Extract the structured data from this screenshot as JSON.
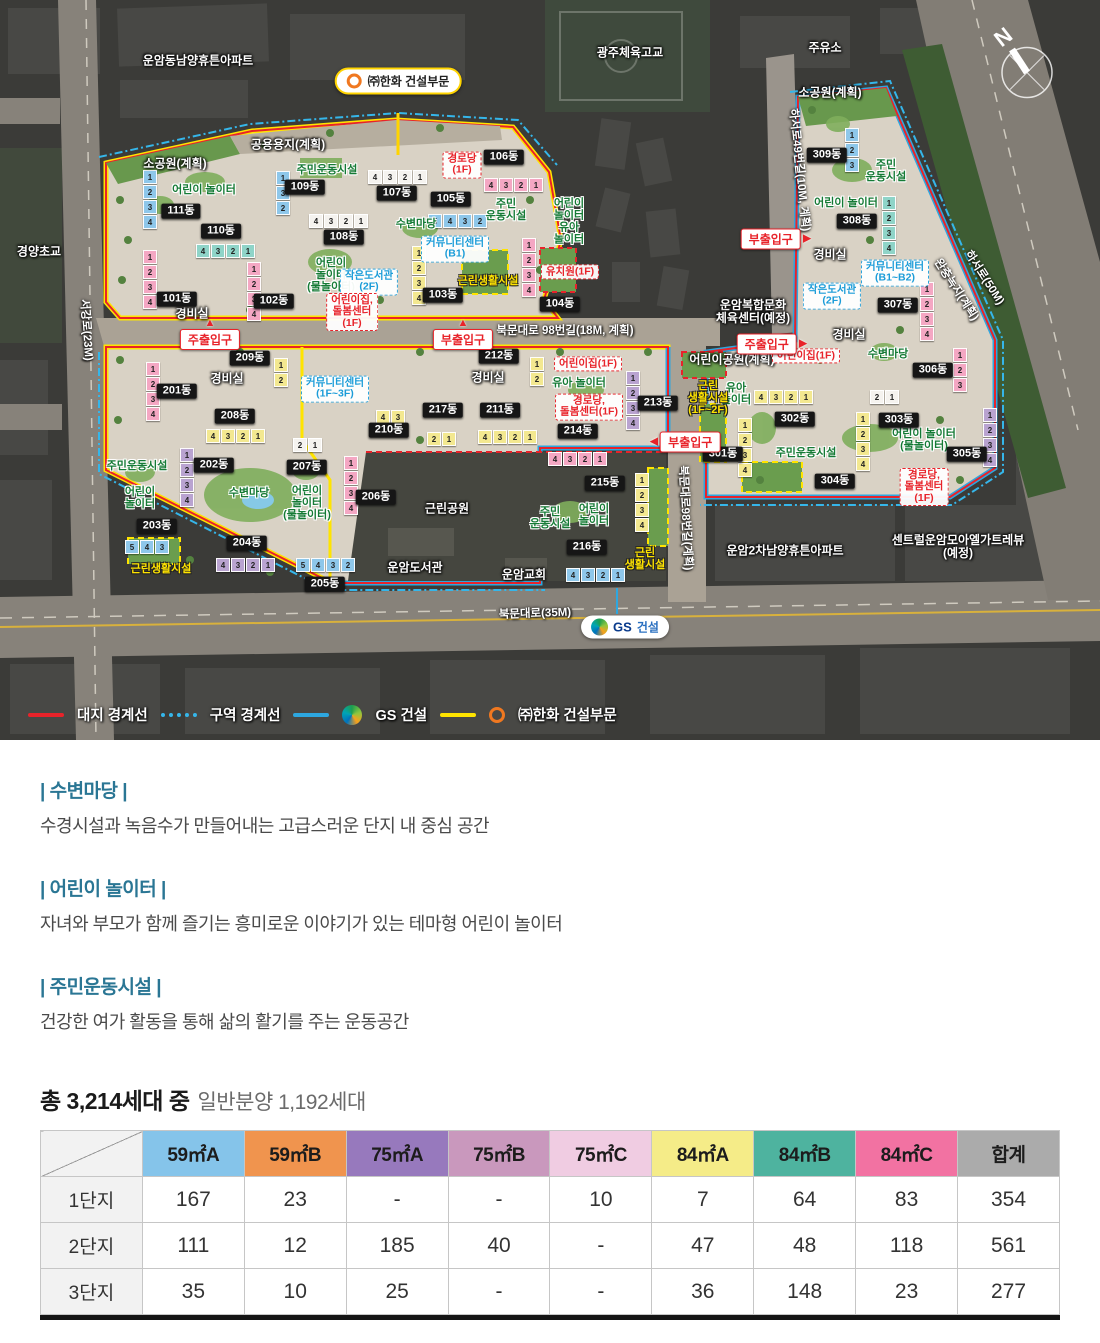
{
  "map": {
    "compass": "N",
    "callout_hanwha": "㈜한화 건설부문",
    "callout_gs_bold": "GS",
    "callout_gs_rest": "건설",
    "landmarks": [
      {
        "t": "운암동남양휴튼아파트",
        "x": 198,
        "y": 61
      },
      {
        "t": "광주체육고교",
        "x": 630,
        "y": 53
      },
      {
        "t": "주유소",
        "x": 825,
        "y": 48
      },
      {
        "t": "경양초교",
        "x": 39,
        "y": 252
      },
      {
        "t": "공용용지(계획)",
        "x": 288,
        "y": 145
      },
      {
        "t": "소공원(계획)",
        "x": 175,
        "y": 164
      },
      {
        "t": "소공원(계획)",
        "x": 830,
        "y": 93
      },
      {
        "t": "운암복합문화\n체육센터(예정)",
        "x": 753,
        "y": 312
      },
      {
        "t": "어린이공원(계획)",
        "x": 732,
        "y": 360
      },
      {
        "t": "근린공원",
        "x": 447,
        "y": 509
      },
      {
        "t": "운암도서관",
        "x": 415,
        "y": 568
      },
      {
        "t": "운암교회",
        "x": 524,
        "y": 575
      },
      {
        "t": "운암2차남양휴튼아파트",
        "x": 785,
        "y": 551
      },
      {
        "t": "센트럴운암모아엘가트레뷰(예정)",
        "x": 958,
        "y": 547
      },
      {
        "t": "경비실",
        "x": 192,
        "y": 314
      },
      {
        "t": "경비실",
        "x": 227,
        "y": 379
      },
      {
        "t": "경비실",
        "x": 488,
        "y": 378
      },
      {
        "t": "경비실",
        "x": 830,
        "y": 255
      },
      {
        "t": "경비실",
        "x": 849,
        "y": 335
      }
    ],
    "road_labels": [
      {
        "t": "북문대로 98번길(18M, 계획)",
        "x": 565,
        "y": 331,
        "r": 0
      },
      {
        "t": "북문대로(35M)",
        "x": 535,
        "y": 614,
        "r": -2
      },
      {
        "t": "서강로(23M)",
        "x": 86,
        "y": 330,
        "r": 86
      },
      {
        "t": "북문대로98번길(계획)",
        "x": 685,
        "y": 518,
        "r": 87
      },
      {
        "t": "하서로49번길(10M, 계획)",
        "x": 799,
        "y": 170,
        "r": 84
      },
      {
        "t": "하서로(50M)",
        "x": 984,
        "y": 278,
        "r": 57
      },
      {
        "t": "완충녹지(계획)",
        "x": 956,
        "y": 290,
        "r": 57
      }
    ],
    "badges": [
      {
        "t": "101동",
        "x": 177,
        "y": 299
      },
      {
        "t": "102동",
        "x": 274,
        "y": 301
      },
      {
        "t": "103동",
        "x": 443,
        "y": 295
      },
      {
        "t": "104동",
        "x": 560,
        "y": 304
      },
      {
        "t": "105동",
        "x": 451,
        "y": 199
      },
      {
        "t": "106동",
        "x": 504,
        "y": 157
      },
      {
        "t": "107동",
        "x": 397,
        "y": 193
      },
      {
        "t": "108동",
        "x": 344,
        "y": 237
      },
      {
        "t": "109동",
        "x": 305,
        "y": 187
      },
      {
        "t": "110동",
        "x": 221,
        "y": 231
      },
      {
        "t": "111동",
        "x": 181,
        "y": 211
      },
      {
        "t": "201동",
        "x": 177,
        "y": 391
      },
      {
        "t": "202동",
        "x": 214,
        "y": 465
      },
      {
        "t": "203동",
        "x": 157,
        "y": 526
      },
      {
        "t": "204동",
        "x": 247,
        "y": 543
      },
      {
        "t": "205동",
        "x": 325,
        "y": 584
      },
      {
        "t": "206동",
        "x": 376,
        "y": 497
      },
      {
        "t": "207동",
        "x": 307,
        "y": 467
      },
      {
        "t": "208동",
        "x": 235,
        "y": 416
      },
      {
        "t": "209동",
        "x": 250,
        "y": 358
      },
      {
        "t": "210동",
        "x": 389,
        "y": 430
      },
      {
        "t": "211동",
        "x": 500,
        "y": 410
      },
      {
        "t": "212동",
        "x": 499,
        "y": 356
      },
      {
        "t": "213동",
        "x": 658,
        "y": 403
      },
      {
        "t": "214동",
        "x": 578,
        "y": 431
      },
      {
        "t": "215동",
        "x": 605,
        "y": 483
      },
      {
        "t": "216동",
        "x": 587,
        "y": 547
      },
      {
        "t": "217동",
        "x": 443,
        "y": 410
      },
      {
        "t": "301동",
        "x": 723,
        "y": 454
      },
      {
        "t": "302동",
        "x": 795,
        "y": 419
      },
      {
        "t": "303동",
        "x": 899,
        "y": 420
      },
      {
        "t": "304동",
        "x": 835,
        "y": 481
      },
      {
        "t": "305동",
        "x": 967,
        "y": 454
      },
      {
        "t": "306동",
        "x": 933,
        "y": 370
      },
      {
        "t": "307동",
        "x": 898,
        "y": 305
      },
      {
        "t": "308동",
        "x": 857,
        "y": 221
      },
      {
        "t": "309동",
        "x": 827,
        "y": 155
      }
    ],
    "green_labels": [
      {
        "t": "어린이 놀이터",
        "x": 204,
        "y": 191
      },
      {
        "t": "주민운동시설",
        "x": 327,
        "y": 171
      },
      {
        "t": "수변마당",
        "x": 416,
        "y": 225
      },
      {
        "t": "주민\n운동시설",
        "x": 506,
        "y": 211
      },
      {
        "t": "어린이\n놀이터\n(물놀이터)",
        "x": 331,
        "y": 276
      },
      {
        "t": "어린이\n놀이터\n유아\n놀이터",
        "x": 569,
        "y": 222
      },
      {
        "t": "주민\n운동시설",
        "x": 886,
        "y": 172
      },
      {
        "t": "어린이 놀이터",
        "x": 846,
        "y": 204
      },
      {
        "t": "수변마당",
        "x": 888,
        "y": 355
      },
      {
        "t": "주민운동시설",
        "x": 806,
        "y": 454
      },
      {
        "t": "어린이 놀이터\n(물놀이터)",
        "x": 924,
        "y": 441
      },
      {
        "t": "유아\n놀이터",
        "x": 736,
        "y": 395
      },
      {
        "t": "유아 놀이터",
        "x": 579,
        "y": 384
      },
      {
        "t": "주민운동시설",
        "x": 137,
        "y": 467
      },
      {
        "t": "어린이\n놀이터",
        "x": 140,
        "y": 499
      },
      {
        "t": "수변마당",
        "x": 249,
        "y": 494
      },
      {
        "t": "어린이\n놀이터\n(물놀이터)",
        "x": 307,
        "y": 504
      },
      {
        "t": "주민\n운동시설",
        "x": 550,
        "y": 519
      },
      {
        "t": "어린이\n놀이터",
        "x": 594,
        "y": 516
      }
    ],
    "red_labels": [
      {
        "t": "경로당\n(1F)",
        "x": 462,
        "y": 165
      },
      {
        "t": "어린이집,\n돌봄센터\n(1F)",
        "x": 352,
        "y": 312
      },
      {
        "t": "유치원(1F)",
        "x": 570,
        "y": 272
      },
      {
        "t": "어린이집(1F)",
        "x": 806,
        "y": 356
      },
      {
        "t": "어린이집(1F)",
        "x": 588,
        "y": 364
      },
      {
        "t": "경로당,\n돌봄센터(1F)",
        "x": 589,
        "y": 407
      },
      {
        "t": "경로당,\n돌봄센터\n(1F)",
        "x": 924,
        "y": 487
      }
    ],
    "blue_labels": [
      {
        "t": "작은도서관\n(2F)",
        "x": 369,
        "y": 282
      },
      {
        "t": "커뮤니티센터\n(B1)",
        "x": 455,
        "y": 249
      },
      {
        "t": "커뮤니티센터\n(1F~3F)",
        "x": 335,
        "y": 389
      },
      {
        "t": "커뮤니티센터\n(B1~B2)",
        "x": 895,
        "y": 273
      },
      {
        "t": "작은도서관\n(2F)",
        "x": 832,
        "y": 296
      }
    ],
    "yellow_labels": [
      {
        "t": "근린생활시설",
        "x": 488,
        "y": 282
      },
      {
        "t": "근린생활시설",
        "x": 161,
        "y": 570
      },
      {
        "t": "근린\n생활시설",
        "x": 645,
        "y": 560
      },
      {
        "t": "근린\n생활시설\n(1F~2F)",
        "x": 708,
        "y": 399
      }
    ],
    "entrances": [
      {
        "t": "주출입구",
        "x": 210,
        "y": 334,
        "d": "up"
      },
      {
        "t": "부출입구",
        "x": 463,
        "y": 334,
        "d": "up"
      },
      {
        "t": "부출입구",
        "x": 776,
        "y": 239,
        "d": "right"
      },
      {
        "t": "주출입구",
        "x": 772,
        "y": 344,
        "d": "right"
      },
      {
        "t": "부출입구",
        "x": 685,
        "y": 442,
        "d": "left"
      }
    ],
    "buildings": [
      {
        "u": [
          "1",
          "2",
          "3",
          "4"
        ],
        "d": "v",
        "c": "pink",
        "x": 143,
        "y": 250
      },
      {
        "u": [
          "1",
          "2",
          "3",
          "4"
        ],
        "d": "v",
        "c": "pink",
        "x": 247,
        "y": 262
      },
      {
        "u": [
          "1",
          "2",
          "3",
          "4"
        ],
        "d": "v",
        "c": "yellow",
        "x": 412,
        "y": 246
      },
      {
        "u": [
          "1",
          "2",
          "3",
          "4"
        ],
        "d": "v",
        "c": "pink",
        "x": 522,
        "y": 238
      },
      {
        "u": [
          "5",
          "4",
          "3",
          "2"
        ],
        "d": "h",
        "c": "blue",
        "x": 428,
        "y": 214
      },
      {
        "u": [
          "4",
          "3",
          "2",
          "1"
        ],
        "d": "h",
        "c": "pink",
        "x": 484,
        "y": 178
      },
      {
        "u": [
          "4",
          "3",
          "2",
          "1"
        ],
        "d": "h",
        "c": "white",
        "x": 368,
        "y": 170
      },
      {
        "u": [
          "4",
          "3",
          "2",
          "1"
        ],
        "d": "h",
        "c": "white",
        "x": 309,
        "y": 214
      },
      {
        "u": [
          "1",
          "3",
          "2"
        ],
        "d": "v",
        "c": "blue",
        "x": 276,
        "y": 171
      },
      {
        "u": [
          "4",
          "3",
          "2",
          "1"
        ],
        "d": "h",
        "c": "teal",
        "x": 196,
        "y": 244
      },
      {
        "u": [
          "1",
          "2",
          "3",
          "4"
        ],
        "d": "v",
        "c": "blue",
        "x": 143,
        "y": 170
      },
      {
        "u": [
          "1",
          "2",
          "3",
          "4"
        ],
        "d": "v",
        "c": "pink",
        "x": 146,
        "y": 362
      },
      {
        "u": [
          "1",
          "2",
          "3",
          "4"
        ],
        "d": "v",
        "c": "purple",
        "x": 180,
        "y": 448
      },
      {
        "u": [
          "5",
          "4",
          "3"
        ],
        "d": "h",
        "c": "blue",
        "x": 125,
        "y": 540
      },
      {
        "u": [
          "4",
          "3",
          "2",
          "1"
        ],
        "d": "h",
        "c": "purple",
        "x": 216,
        "y": 558
      },
      {
        "u": [
          "5",
          "4",
          "3",
          "2"
        ],
        "d": "h",
        "c": "blue",
        "x": 296,
        "y": 558
      },
      {
        "u": [
          "1",
          "2",
          "3",
          "4"
        ],
        "d": "v",
        "c": "pink",
        "x": 344,
        "y": 456
      },
      {
        "u": [
          "2",
          "1"
        ],
        "d": "h",
        "c": "white",
        "x": 293,
        "y": 438
      },
      {
        "u": [
          "4",
          "3",
          "2",
          "1"
        ],
        "d": "h",
        "c": "yellow",
        "x": 206,
        "y": 429
      },
      {
        "u": [
          "1",
          "2"
        ],
        "d": "v",
        "c": "yellow",
        "x": 274,
        "y": 358
      },
      {
        "u": [
          "4",
          "3"
        ],
        "d": "h",
        "c": "yellow",
        "x": 376,
        "y": 410
      },
      {
        "u": [
          "4",
          "3",
          "2",
          "1"
        ],
        "d": "h",
        "c": "yellow",
        "x": 478,
        "y": 430
      },
      {
        "u": [
          "1",
          "2"
        ],
        "d": "v",
        "c": "yellow",
        "x": 530,
        "y": 357
      },
      {
        "u": [
          "1",
          "2",
          "3",
          "4"
        ],
        "d": "v",
        "c": "purple",
        "x": 626,
        "y": 371
      },
      {
        "u": [
          "4",
          "3",
          "2",
          "1"
        ],
        "d": "h",
        "c": "pink",
        "x": 548,
        "y": 452
      },
      {
        "u": [
          "1",
          "2",
          "3",
          "4"
        ],
        "d": "v",
        "c": "yellow",
        "x": 635,
        "y": 473
      },
      {
        "u": [
          "4",
          "3",
          "2",
          "1"
        ],
        "d": "h",
        "c": "blue",
        "x": 566,
        "y": 568
      },
      {
        "u": [
          "2",
          "1"
        ],
        "d": "h",
        "c": "yellow",
        "x": 427,
        "y": 432
      },
      {
        "u": [
          "1",
          "2",
          "3",
          "4"
        ],
        "d": "v",
        "c": "yellow",
        "x": 738,
        "y": 418
      },
      {
        "u": [
          "4",
          "3",
          "2",
          "1"
        ],
        "d": "h",
        "c": "yellow",
        "x": 754,
        "y": 390
      },
      {
        "u": [
          "2",
          "1"
        ],
        "d": "h",
        "c": "white",
        "x": 870,
        "y": 390
      },
      {
        "u": [
          "1",
          "2",
          "3",
          "4"
        ],
        "d": "v",
        "c": "yellow",
        "x": 856,
        "y": 412
      },
      {
        "u": [
          "1",
          "2",
          "3",
          "4"
        ],
        "d": "v",
        "c": "purple",
        "x": 983,
        "y": 408
      },
      {
        "u": [
          "1",
          "2",
          "3"
        ],
        "d": "v",
        "c": "pink",
        "x": 953,
        "y": 348
      },
      {
        "u": [
          "1",
          "2",
          "3",
          "4"
        ],
        "d": "v",
        "c": "pink",
        "x": 920,
        "y": 282
      },
      {
        "u": [
          "1",
          "2",
          "3",
          "4"
        ],
        "d": "v",
        "c": "teal",
        "x": 882,
        "y": 196
      },
      {
        "u": [
          "1",
          "2",
          "3"
        ],
        "d": "v",
        "c": "blue",
        "x": 845,
        "y": 128
      }
    ]
  },
  "legend": {
    "site_boundary": "대지 경계선",
    "zone_boundary": "구역 경계선",
    "gs_bold": "GS",
    "gs_rest": "건설",
    "hanwha": "㈜한화 건설부문"
  },
  "sections": [
    {
      "title": "| 수변마당 |",
      "desc": "수경시설과 녹음수가 만들어내는 고급스러운 단지 내 중심 공간"
    },
    {
      "title": "| 어린이 놀이터 |",
      "desc": "자녀와 부모가 함께 즐기는 흥미로운 이야기가 있는 테마형 어린이 놀이터"
    },
    {
      "title": "| 주민운동시설 |",
      "desc": "건강한 여가 활동을 통해 삶의 활기를 주는 운동공간"
    }
  ],
  "summary": {
    "bold": "총 3,214세대 중",
    "normal": "일반분양 1,192세대"
  },
  "table": {
    "headers": [
      {
        "label": "59㎡A",
        "color": "#85c4ea"
      },
      {
        "label": "59㎡B",
        "color": "#f0944e"
      },
      {
        "label": "75㎡A",
        "color": "#9779bd"
      },
      {
        "label": "75㎡B",
        "color": "#c998bd"
      },
      {
        "label": "75㎡C",
        "color": "#f0cce2"
      },
      {
        "label": "84㎡A",
        "color": "#f5ec88"
      },
      {
        "label": "84㎡B",
        "color": "#4eb39f"
      },
      {
        "label": "84㎡C",
        "color": "#f272a2"
      },
      {
        "label": "합계",
        "color": "#ababab"
      }
    ],
    "rows": [
      {
        "label": "1단지",
        "values": [
          "167",
          "23",
          "-",
          "-",
          "10",
          "7",
          "64",
          "83",
          "354"
        ]
      },
      {
        "label": "2단지",
        "values": [
          "111",
          "12",
          "185",
          "40",
          "-",
          "47",
          "48",
          "118",
          "561"
        ]
      },
      {
        "label": "3단지",
        "values": [
          "35",
          "10",
          "25",
          "-",
          "-",
          "36",
          "148",
          "23",
          "277"
        ]
      }
    ]
  }
}
